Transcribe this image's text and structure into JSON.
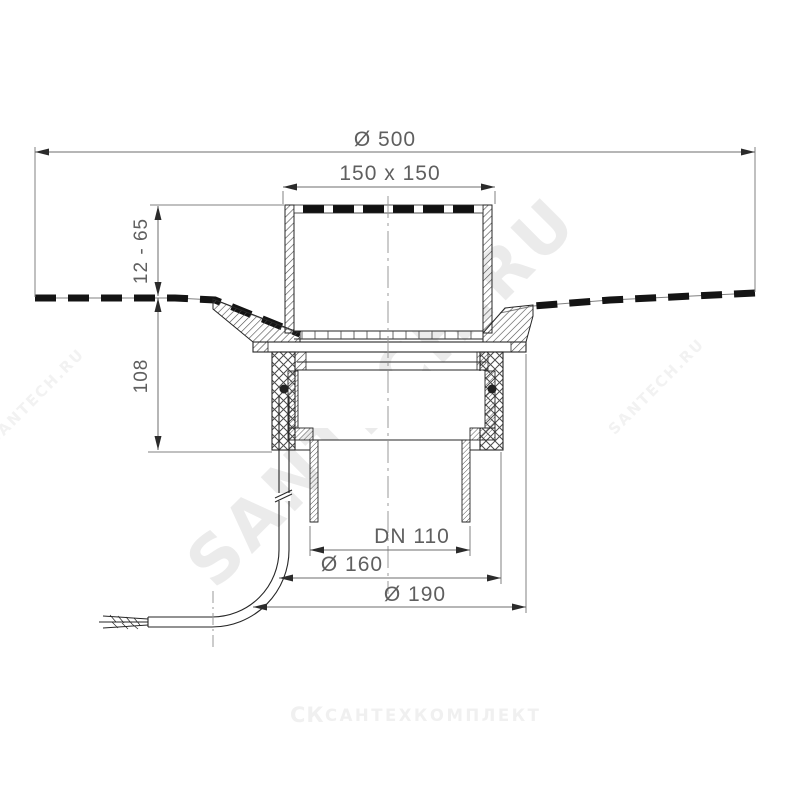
{
  "dimensions": {
    "diameter_top": "Ø 500",
    "grate_size": "150 x 150",
    "mounting_height": "12 - 65",
    "body_height": "108",
    "outlet_diameter": "DN 110",
    "body_diameter": "Ø 160",
    "flange_diameter": "Ø 190"
  },
  "watermarks": {
    "main": "SANTECH.RU",
    "left": "SANTECH.RU",
    "right": "SANTECH.RU"
  },
  "logo": {
    "mark": "СК",
    "text": "САНТЕХКОМПЛЕКТ"
  },
  "colors": {
    "line": "#262626",
    "dimension_text": "#5f5f5f",
    "watermark": "#ebebeb"
  }
}
